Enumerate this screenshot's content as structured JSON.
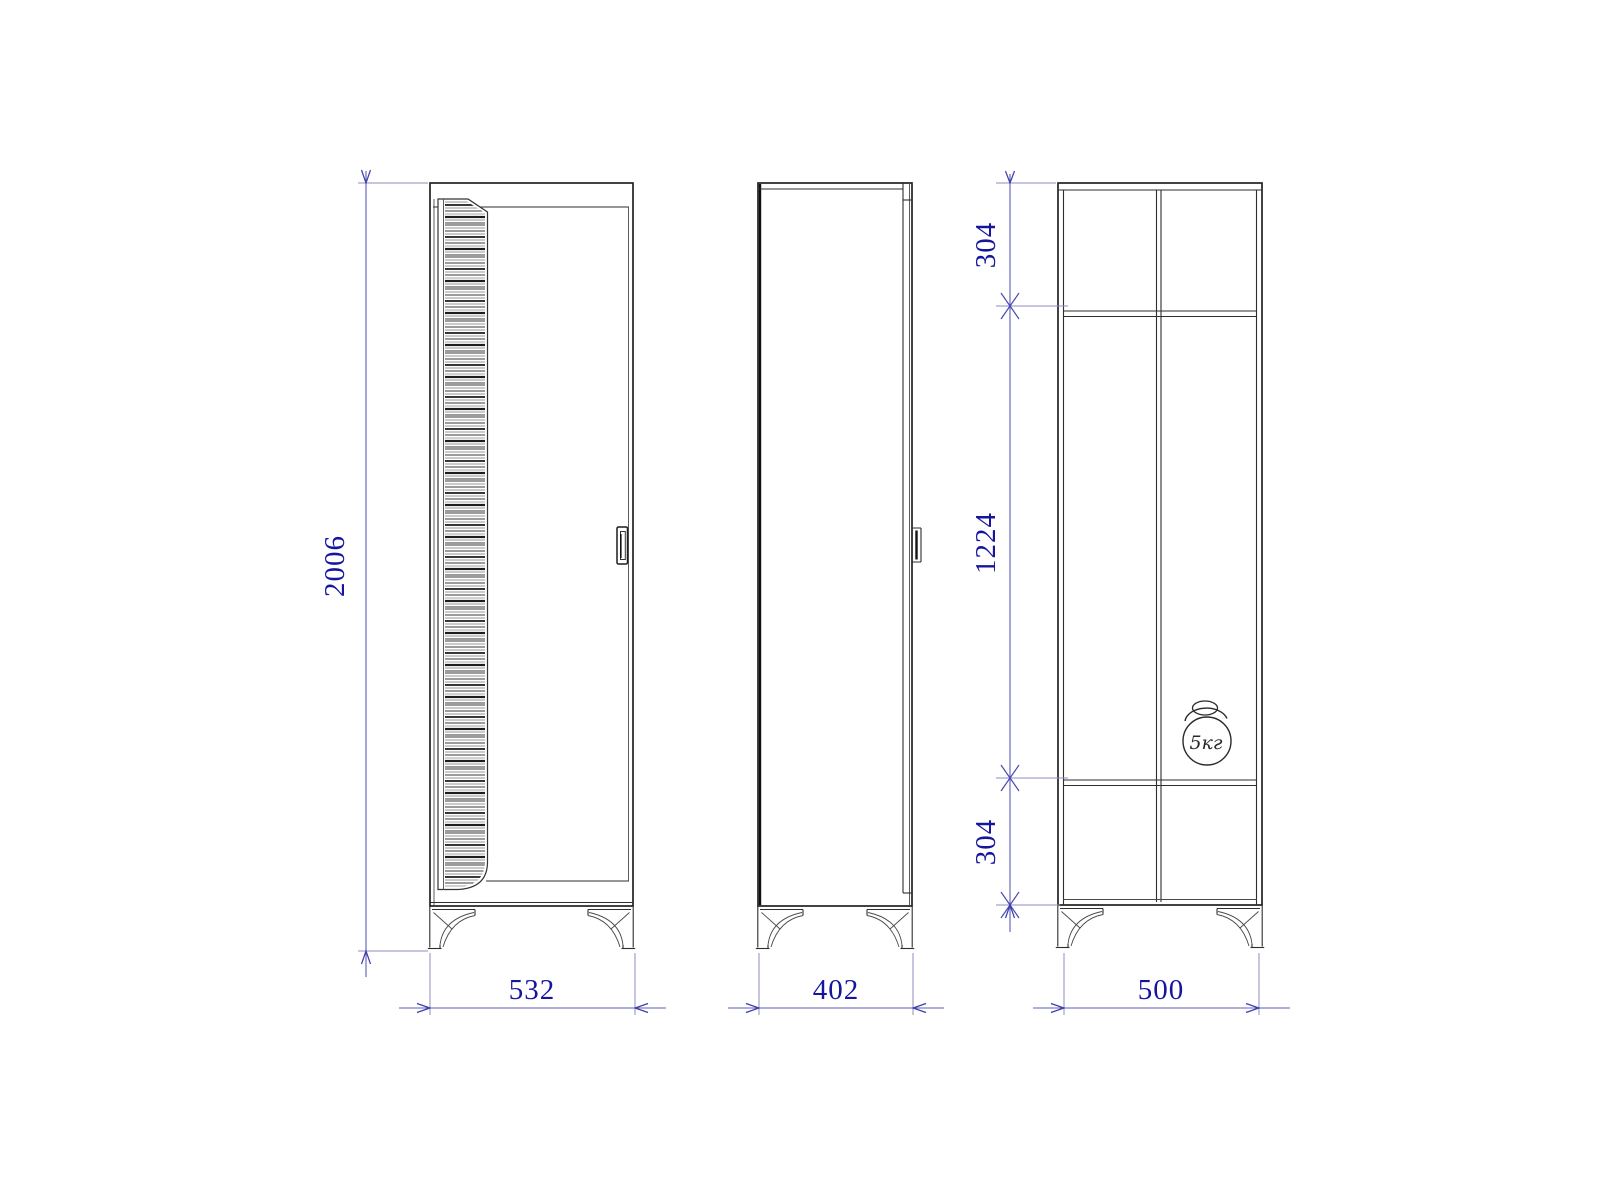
{
  "palette": {
    "background": "#ffffff",
    "drawing_line": "#222222",
    "dimension_text": "#15159e",
    "dimension_line": "#5c5cb8"
  },
  "dimensions": {
    "overall_height": "2006",
    "front_width": "532",
    "side_depth": "402",
    "section_width": "500",
    "top_compartment": "304",
    "middle_compartment": "1224",
    "bottom_compartment": "304"
  },
  "annotations": {
    "max_load": "5кг"
  }
}
